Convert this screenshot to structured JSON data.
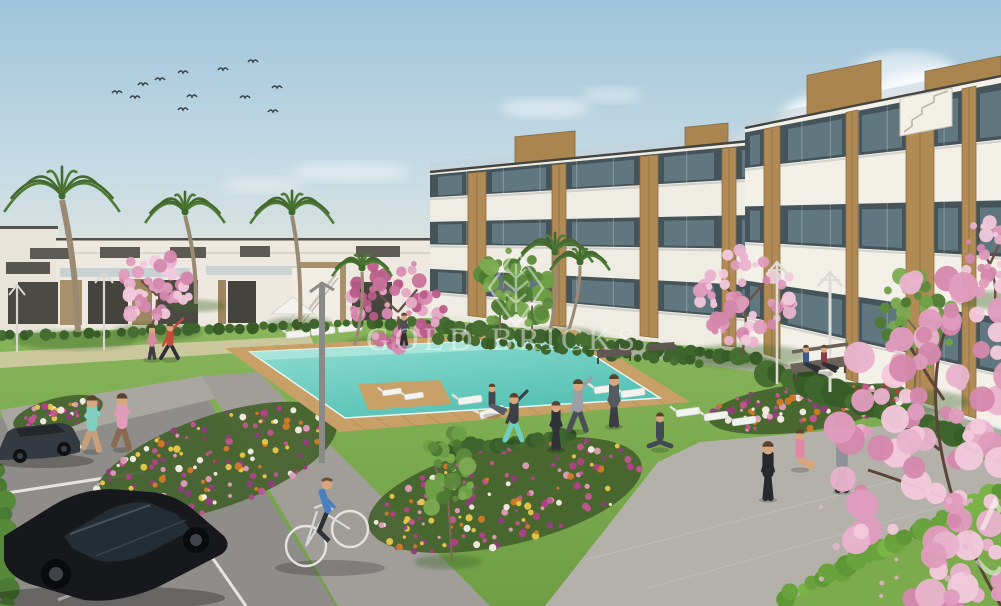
{
  "page": {
    "type": "architectural-exterior-render",
    "subject": "modern white apartment complex with pool, gardens, parking and people"
  },
  "watermark": {
    "text": "GOLD BRICKS",
    "emblem": "diamond-tree-logo",
    "color": "#ffffff",
    "opacity": 0.45
  },
  "corner_mark": {
    "description": "partial white watermark strokes at right edge"
  },
  "scene": {
    "sky": {
      "top_color": "#9fc4db",
      "horizon_color": "#ece7d9",
      "birds_count": 12,
      "cloud_clusters": 5
    },
    "buildings": {
      "style": "modern flat-roof apartments",
      "floors": 3,
      "facade_color": "#f3f0e8",
      "wood_accent_color": "#b18b55",
      "glass_color": "#45545b",
      "features": [
        "glass balconies",
        "wood slat panels",
        "rooftop wood boxes",
        "external stair"
      ]
    },
    "pool": {
      "water_color": "#57c3b6",
      "shallow_color": "#aee6dc",
      "deck_color": "#c8a068",
      "loungers": 12,
      "parasols": 1
    },
    "landscape": {
      "lawn_color": "#7dac50",
      "palm_trees": 5,
      "blossom_trees": 5,
      "green_trees": 3,
      "flower_beds": 5,
      "flower_colors": [
        "#d07a28",
        "#c2568f",
        "#e09cb8",
        "#8e3f7a",
        "#e8c84a"
      ]
    },
    "people": {
      "joggers": 2,
      "cyclist": 1,
      "lawn_exercisers": 6,
      "plaza_exercisers": 3,
      "bench_sitters": 2,
      "walkers": 3
    },
    "vehicles": {
      "parked_cars": 2,
      "car_colors": [
        "#333a41",
        "#16181c"
      ],
      "bicycles": 1
    },
    "street_lamps": 5,
    "paths": {
      "parking_color": "#8f8d89",
      "walkway_color": "#a8a5a0",
      "plaza_color": "#b4b1aa"
    }
  }
}
